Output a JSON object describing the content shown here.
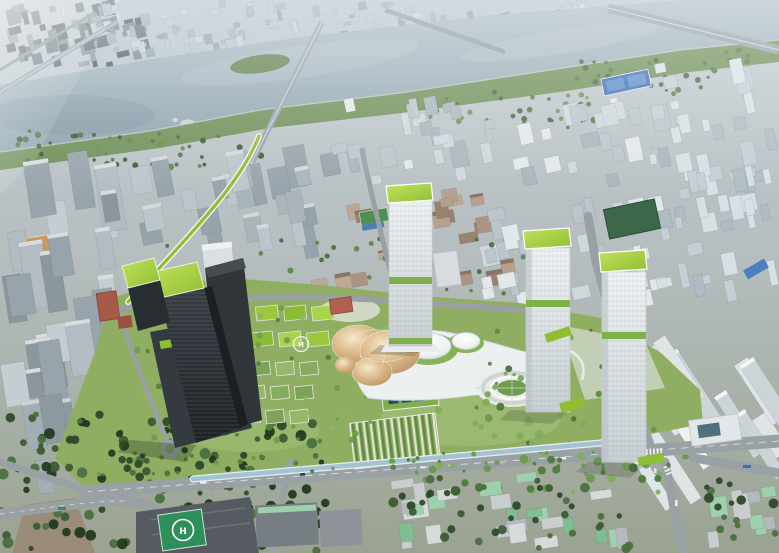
{
  "meta": {
    "description": "Aerial bird's-eye architectural rendering of a riverside urban masterplan: a landscaped development site with green-roofed towers, a golden canopy pavilion, white podium domes and gardens, surrounded by dense apartment districts and a wide river with bridges at the top."
  },
  "labels": {
    "helipad_marking": "H"
  },
  "palette": {
    "river": "#8fa5b1",
    "park_green": "#8fae62",
    "lawn": "#9cba72",
    "embankment": "#6f8f58",
    "road": "#9aa1a5",
    "canal": "#a4c3d2",
    "roof_green": "#9cc83e",
    "roof_green_deep": "#8fbe33",
    "dark_tower": "#24282c",
    "white_tower": "#e8edef",
    "band_green": "#7fb04a",
    "gold": "#d8b488",
    "court_blue": "#3d6fb4",
    "helipad_green": "#2f8f5b",
    "brick_red": "#a85a48",
    "tree_dark": "#3d5c33"
  },
  "scene": {
    "width": 779,
    "height": 553,
    "fields": [
      {
        "id": "fld-farcity-dark",
        "x": 0,
        "y": 0,
        "w": 150,
        "h": 68,
        "count": 60,
        "minW": 4,
        "maxW": 14,
        "minH": 4,
        "maxH": 16,
        "angle": -14,
        "colors": [
          "#5f7078",
          "#49585f",
          "#76858d",
          "#8a98a0"
        ],
        "seed": 11
      },
      {
        "id": "fld-farcity",
        "x": 60,
        "y": 0,
        "w": 640,
        "h": 58,
        "count": 150,
        "minW": 3,
        "maxW": 10,
        "minH": 3,
        "maxH": 12,
        "angle": -12,
        "colors": [
          "#9db0bb",
          "#b3c2cb",
          "#8da0ac",
          "#c2cfd6"
        ],
        "seed": 22
      },
      {
        "id": "fld-left1",
        "x": 0,
        "y": 148,
        "w": 135,
        "h": 262,
        "count": 26,
        "minW": 13,
        "maxW": 26,
        "minH": 28,
        "maxH": 68,
        "angle": -9,
        "colors": [
          "#b2bcc2",
          "#98a4ab",
          "#c6cdd2",
          "#8b969d"
        ],
        "roof": "#d8dde0",
        "roofChance": 0.55,
        "seed": 33
      },
      {
        "id": "fld-left2",
        "x": 125,
        "y": 145,
        "w": 215,
        "h": 118,
        "count": 24,
        "minW": 10,
        "maxW": 22,
        "minH": 18,
        "maxH": 46,
        "angle": -11,
        "colors": [
          "#a9b4bb",
          "#97a3ab",
          "#bcc5cb"
        ],
        "roof": "#d2d8dc",
        "roofChance": 0.45,
        "seed": 44
      },
      {
        "id": "fld-leftbottom",
        "x": 0,
        "y": 393,
        "w": 125,
        "h": 112,
        "count": 9,
        "minW": 14,
        "maxW": 26,
        "minH": 30,
        "maxH": 58,
        "angle": -9,
        "colors": [
          "#a3adb4",
          "#8e999f",
          "#b8c0c5"
        ],
        "roof": "#cdd3d6",
        "roofChance": 0.6,
        "seed": 55
      },
      {
        "id": "fld-brick",
        "x": 295,
        "y": 188,
        "w": 220,
        "h": 102,
        "count": 26,
        "minW": 9,
        "maxW": 20,
        "minH": 8,
        "maxH": 18,
        "angle": -10,
        "colors": [
          "#ac9484",
          "#bda795",
          "#99826f",
          "#b8a08e"
        ],
        "roof": "#8a7462",
        "roofChance": 0.4,
        "seed": 99
      },
      {
        "id": "fld-rightA",
        "x": 330,
        "y": 96,
        "w": 340,
        "h": 96,
        "count": 45,
        "minW": 7,
        "maxW": 18,
        "minH": 9,
        "maxH": 26,
        "angle": -12,
        "colors": [
          "#cfd7db",
          "#bcc5cb",
          "#e2e7e9",
          "#aab5bd"
        ],
        "seed": 66
      },
      {
        "id": "fld-rightB",
        "x": 480,
        "y": 188,
        "w": 190,
        "h": 118,
        "count": 36,
        "minW": 7,
        "maxW": 18,
        "minH": 10,
        "maxH": 28,
        "angle": -12,
        "colors": [
          "#cfd7db",
          "#bcc5cb",
          "#e2e7e9"
        ],
        "seed": 67
      },
      {
        "id": "fld-rightfar",
        "x": 640,
        "y": 55,
        "w": 139,
        "h": 248,
        "count": 55,
        "minW": 6,
        "maxW": 16,
        "minH": 8,
        "maxH": 26,
        "angle": -12,
        "colors": [
          "#c3ced6",
          "#d8e0e5",
          "#b0bcc5"
        ],
        "seed": 77
      },
      {
        "id": "fld-rightslabs",
        "x": 635,
        "y": 298,
        "w": 144,
        "h": 218,
        "count": 14,
        "minW": 11,
        "maxW": 18,
        "minH": 45,
        "maxH": 108,
        "angle": -33,
        "colors": [
          "#dfe4e7",
          "#cdd4d8",
          "#eef1f2"
        ],
        "roof": "#f4f6f7",
        "roofChance": 0.6,
        "seed": 88
      },
      {
        "id": "fld-oldtown1",
        "x": 380,
        "y": 470,
        "w": 250,
        "h": 80,
        "count": 26,
        "minW": 9,
        "maxW": 26,
        "minH": 8,
        "maxH": 22,
        "angle": -8,
        "colors": [
          "#c8cdce",
          "#b4babc",
          "#9fd0ae",
          "#7fbd92",
          "#d6dadb"
        ],
        "seed": 111
      },
      {
        "id": "fld-oldtown2",
        "x": 695,
        "y": 475,
        "w": 84,
        "h": 75,
        "count": 10,
        "minW": 9,
        "maxW": 22,
        "minH": 8,
        "maxH": 20,
        "angle": -8,
        "colors": [
          "#c8cdce",
          "#9fd0ae",
          "#b4babc"
        ],
        "seed": 112
      }
    ],
    "trees": [
      {
        "id": "trs-riverside",
        "x": 0,
        "y": 131,
        "w": 262,
        "h": 36,
        "count": 45,
        "rmin": 1.5,
        "rmax": 3.5,
        "colors": [
          "#4c7340",
          "#3a5a32",
          "#5d8a4a"
        ],
        "seed": 301
      },
      {
        "id": "trs-embank",
        "x": 430,
        "y": 92,
        "w": 165,
        "h": 36,
        "count": 34,
        "rmin": 1.5,
        "rmax": 3.2,
        "colors": [
          "#56774a",
          "#47643d",
          "#6b8f57"
        ],
        "seed": 302
      },
      {
        "id": "trs-embank",
        "x": 575,
        "y": 60,
        "w": 135,
        "h": 34,
        "count": 26,
        "rmin": 1.5,
        "rmax": 3,
        "colors": [
          "#56774a",
          "#47643d"
        ],
        "seed": 303
      },
      {
        "id": "trs-embank",
        "x": 695,
        "y": 45,
        "w": 84,
        "h": 28,
        "count": 16,
        "rmin": 1.5,
        "rmax": 3,
        "colors": [
          "#56774a",
          "#6b8f57"
        ],
        "seed": 304
      },
      {
        "id": "trs-forest",
        "x": 0,
        "y": 412,
        "w": 330,
        "h": 141,
        "count": 150,
        "rmin": 2.5,
        "rmax": 5.5,
        "colors": [
          "#2e4929",
          "#3d5c33",
          "#4b7040",
          "#223a20"
        ],
        "seed": 305
      },
      {
        "id": "trs-bottomright",
        "x": 392,
        "y": 478,
        "w": 240,
        "h": 75,
        "count": 40,
        "rmin": 2.5,
        "rmax": 5,
        "colors": [
          "#2e4929",
          "#3d5c33",
          "#4b7040"
        ],
        "seed": 306
      },
      {
        "id": "trs-bottomright",
        "x": 700,
        "y": 480,
        "w": 79,
        "h": 73,
        "count": 15,
        "rmin": 2.5,
        "rmax": 5,
        "colors": [
          "#2e4929",
          "#4b7040"
        ],
        "seed": 312
      },
      {
        "id": "trs-midgreens",
        "x": 425,
        "y": 398,
        "w": 235,
        "h": 95,
        "count": 55,
        "rmin": 2,
        "rmax": 4.5,
        "colors": [
          "#4f7a3e",
          "#69984f",
          "#7fae5d"
        ],
        "seed": 307
      },
      {
        "id": "trs-sitegardens",
        "x": 132,
        "y": 308,
        "w": 255,
        "h": 135,
        "count": 60,
        "rmin": 1.5,
        "rmax": 3.5,
        "colors": [
          "#55803f",
          "#6f9e50",
          "#8ab864"
        ],
        "seed": 308
      },
      {
        "id": "trs-street",
        "x": 88,
        "y": 452,
        "w": 600,
        "h": 24,
        "count": 46,
        "rmin": 1.5,
        "rmax": 2.8,
        "colors": [
          "#55803f",
          "#6a9a4e"
        ],
        "seed": 309
      },
      {
        "id": "trs-parkeast",
        "x": 475,
        "y": 330,
        "w": 180,
        "h": 78,
        "count": 36,
        "rmin": 1.5,
        "rmax": 3.5,
        "colors": [
          "#5d8a46",
          "#79a85a",
          "#4b7338"
        ],
        "seed": 310
      },
      {
        "id": "trs-north",
        "x": 140,
        "y": 238,
        "w": 390,
        "h": 58,
        "count": 26,
        "rmin": 1.5,
        "rmax": 3.5,
        "colors": [
          "#4c7340",
          "#5d8a4a"
        ],
        "seed": 311
      }
    ],
    "grids": [
      {
        "id": "grd-roofs",
        "x": 256,
        "y": 306,
        "cols": 3,
        "rows": 2,
        "cw": 22,
        "ch": 14,
        "gx": 28,
        "gy": 26,
        "shear": -5,
        "angle": -6,
        "colors": [
          "#9cc83e",
          "#8abc35",
          "#a7d44a"
        ],
        "stroke": "#dfe3e0"
      },
      {
        "id": "grd-garden",
        "x": 252,
        "y": 362,
        "cols": 3,
        "rows": 3,
        "cw": 18,
        "ch": 13,
        "gx": 24,
        "gy": 24,
        "shear": -5,
        "angle": -6,
        "colors": [
          "#7da35a",
          "#94b96a",
          "#86ad5f"
        ],
        "stroke": "#e3e6de"
      }
    ]
  }
}
